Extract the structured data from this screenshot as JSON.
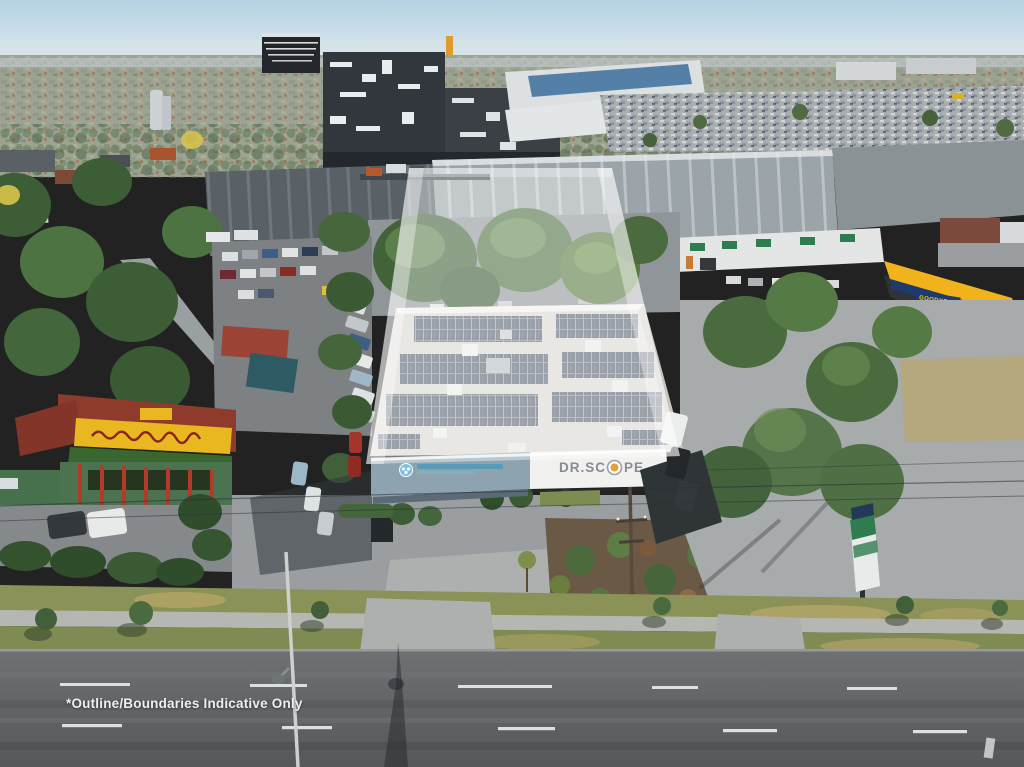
{
  "disclaimer": {
    "text": "*Outline/Boundaries Indicative Only"
  },
  "subject_signage": {
    "full": "DR.SCOPE",
    "left": "DR.SC",
    "right": "PE"
  },
  "neighbor_signage": {
    "goodyear_fascia": "GOODYEAR",
    "goodyear_sign": "GOODYEAR"
  },
  "colors": {
    "sky_top": "#b4d2e3",
    "overlay_fill": "rgba(255,255,255,0.40)",
    "overlay_edge": "rgba(255,255,255,0.38)",
    "goodyear_yellow": "#f0b31c",
    "goodyear_blue": "#1e3b6e",
    "goodyear_text_yellow": "#ffd71e",
    "restaurant_sign_yellow": "#e9b71f",
    "logo_orange": "#e2a23b",
    "logo_teal": "#4d9ab8",
    "road_marking_white": "#e9ebe9"
  }
}
